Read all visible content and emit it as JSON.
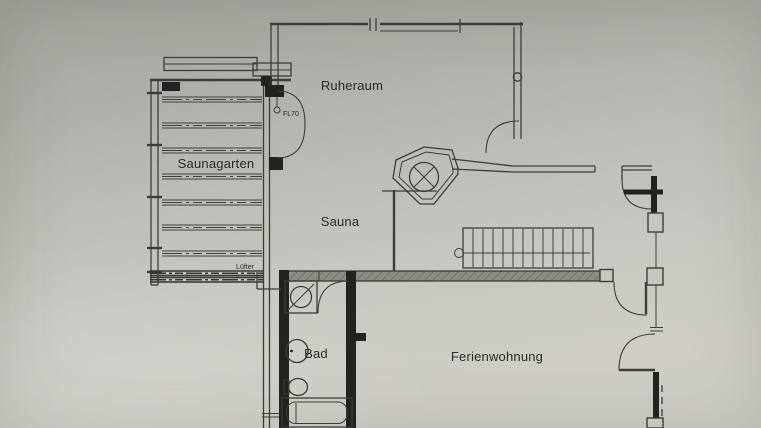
{
  "document_type": "floor-plan scan",
  "colors": {
    "paper_top": "#a4a39d",
    "paper_bottom": "#d1cec8",
    "ink": "#3e3c38",
    "wall": "#232220",
    "label": "#2a2927",
    "band": "#8e8b84"
  },
  "rooms": {
    "ruheraum": {
      "label": "Ruheraum"
    },
    "saunagarten": {
      "label": "Saunagarten"
    },
    "sauna": {
      "label": "Sauna"
    },
    "bad": {
      "label": "Bad"
    },
    "ferienwohnung": {
      "label": "Ferienwohnung"
    }
  },
  "annotations": {
    "fl70": {
      "label": "FL70"
    },
    "luefter": {
      "label": "Lüfter"
    }
  },
  "icons": [
    "sauna-heater-icon",
    "staircase-icon",
    "shower-icon",
    "washbasin-icon",
    "toilet-icon",
    "bathtub-icon",
    "door-swing-icon",
    "window-icon",
    "vent-duct-icon",
    "louver-decking-icon"
  ]
}
